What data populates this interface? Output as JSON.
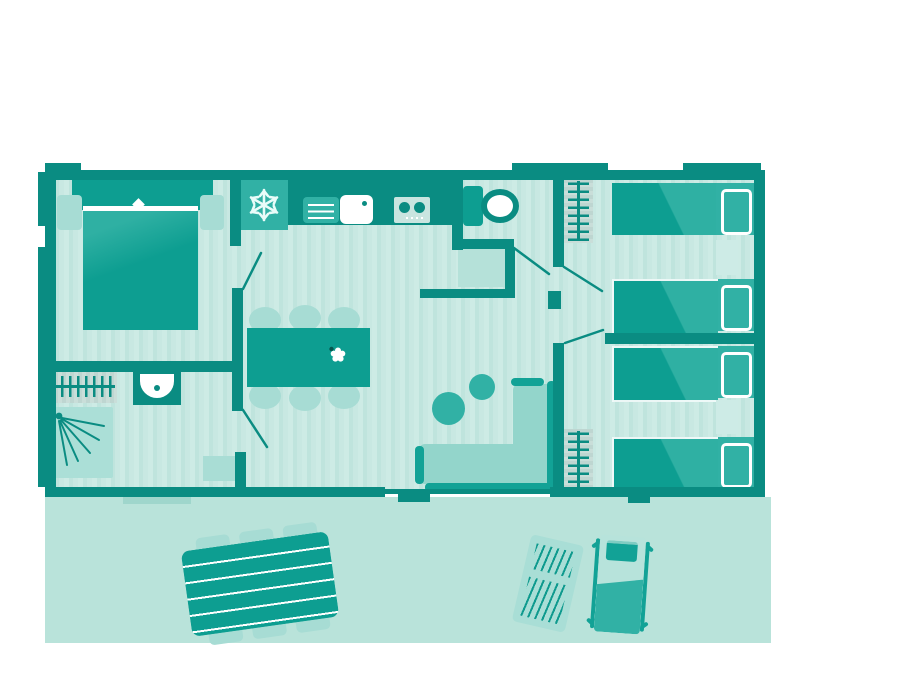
{
  "meta": {
    "type": "floor-plan-illustration",
    "subject": "mobile home / cottage top-down floor plan with outdoor terrace",
    "canvas": {
      "width": 900,
      "height": 675
    },
    "visible_text": "none"
  },
  "palette": {
    "background": "#ffffff",
    "wall": "#0a8c82",
    "furniture_dark": "#0d9e91",
    "furniture_highlight": "#2fb0a3",
    "accent_medium": "#31b1a5",
    "seat_light": "#93d5cb",
    "chair_light": "#a7dcd4",
    "floor_base": "#cdebe5",
    "floor_stripe": "#bfe4dd",
    "wardrobe_block": "#c6ded9",
    "terrace": "#b9e3da",
    "shower_tray": "#abdfd7",
    "white": "#ffffff"
  },
  "rooms": [
    {
      "id": "master-bedroom",
      "contents": [
        "double-bed",
        "nightstand-left",
        "nightstand-right"
      ]
    },
    {
      "id": "bathroom",
      "contents": [
        "wardrobe-rail",
        "washbasin",
        "shower"
      ]
    },
    {
      "id": "kitchen",
      "contents": [
        "fridge",
        "counter",
        "dish-drainer",
        "sink",
        "stove-2-burners"
      ]
    },
    {
      "id": "wc",
      "contents": [
        "toilet"
      ]
    },
    {
      "id": "living-dining",
      "contents": [
        "dining-table",
        "six-chairs",
        "flower-centerpiece",
        "two-poufs",
        "l-shaped-sofa",
        "hall-cabinet",
        "entry-cabinet"
      ]
    },
    {
      "id": "bedroom-2",
      "contents": [
        "single-bed",
        "single-bed",
        "bedside-table",
        "wardrobe-rail"
      ]
    },
    {
      "id": "bedroom-3",
      "contents": [
        "single-bed",
        "single-bed",
        "bedside-table",
        "wardrobe-rail"
      ]
    },
    {
      "id": "terrace",
      "contents": [
        "picnic-table-6-seats",
        "slatted-sun-lounger",
        "padded-sun-lounger"
      ]
    }
  ],
  "icons": [
    "snowflake-icon",
    "flower-icon",
    "shower-spray-icon",
    "hanger-rail-icon",
    "sink-drain-icon",
    "burner-icon",
    "door-swing-icon"
  ],
  "counts": {
    "single_beds": 4,
    "double_beds": 1,
    "doors": 5,
    "wardrobe_rails": 3,
    "sun_loungers": 2
  }
}
